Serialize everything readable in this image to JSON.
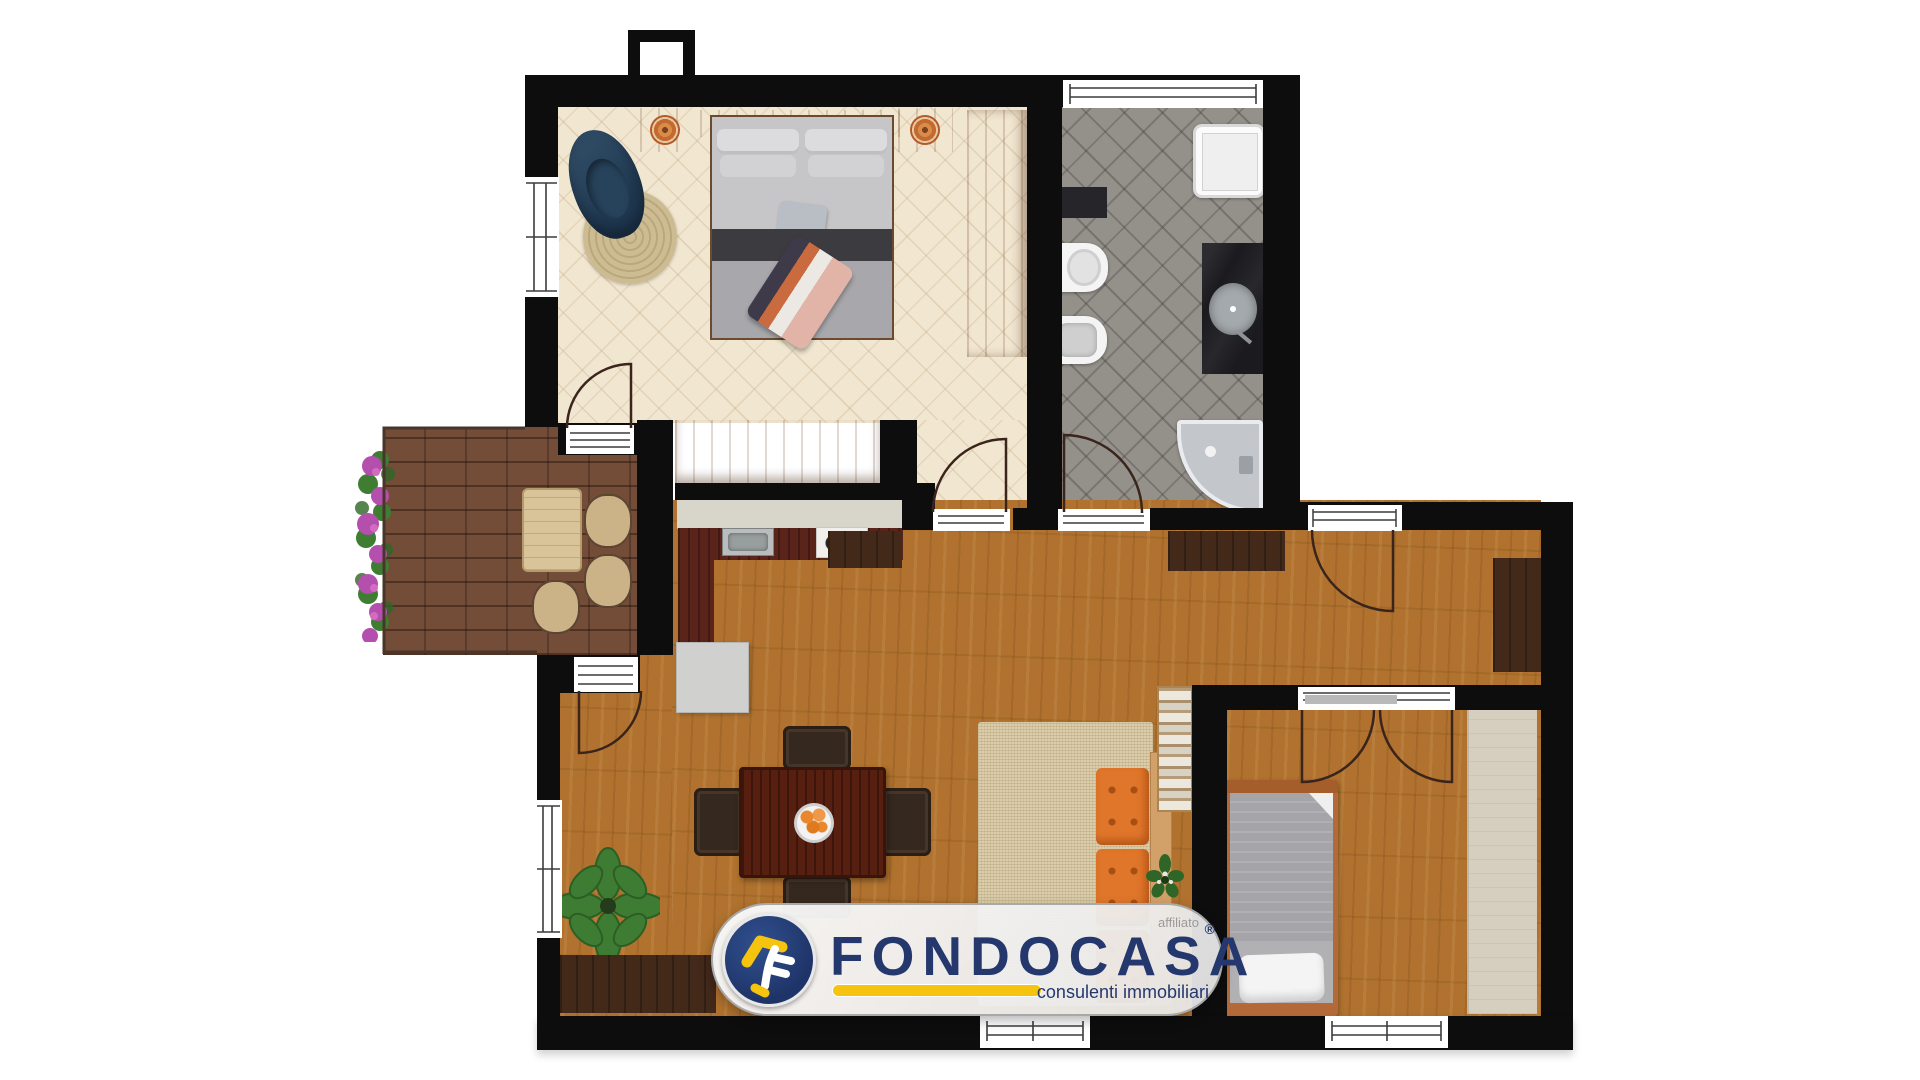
{
  "watermark": {
    "affiliate_label": "affiliato",
    "brand": "FONDOCASA",
    "registered_mark": "®",
    "tagline": "consulenti immobiliari",
    "colors": {
      "navy": "#25386e",
      "yellow": "#f6c40e",
      "pill_bg": "#f2f1ef",
      "pill_border": "#a8a8a8",
      "affiliate_gray": "#9a9a9a"
    }
  },
  "palette": {
    "background": "#ffffff",
    "wall": "#0d0d0d",
    "bedroom_floor": "#f1e6d0",
    "bathroom_floor": "#94908a",
    "balcony_floor": "#744d39",
    "wood_floor": "#b0722e",
    "light_wood_furniture": "#b3702c",
    "dark_wood_furniture": "#43291a",
    "kitchen_counter_top": "#d8d5ca",
    "kitchen_counter_base": "#5a241b",
    "rug_beige": "#dbcda9",
    "sofa_orange": "#e0762a",
    "plant_green": "#3d7c32",
    "flower_magenta": "#b44fae"
  },
  "floor_plan": {
    "type": "residential-apartment-2d-render",
    "rooms": [
      {
        "id": "bedroom-1",
        "position": "top-left",
        "floor": "cream-tile",
        "furniture": [
          "double-bed",
          "headboard-shelf",
          "nightstand-left",
          "nightstand-right",
          "wall-plate-left",
          "wall-plate-right",
          "round-jute-rug",
          "blue-armchair",
          "wardrobe-right",
          "wardrobe-bottom",
          "folded-throw"
        ]
      },
      {
        "id": "bathroom",
        "position": "top-right",
        "floor": "gray-tile",
        "furniture": [
          "shower-tray",
          "toilet",
          "bidet",
          "black-vanity-round-basin",
          "corner-bathtub",
          "wall-shelf"
        ]
      },
      {
        "id": "balcony",
        "position": "left",
        "floor": "brick-tile",
        "furniture": [
          "flower-planter",
          "outdoor-table",
          "outdoor-chairs"
        ]
      },
      {
        "id": "living-kitchen",
        "position": "center",
        "floor": "oak-plank",
        "furniture": [
          "kitchen-counter-sink-stove",
          "kitchen-island-table",
          "sideboard-left",
          "sideboard-tv",
          "corner-cabinet",
          "dining-table",
          "dining-chairs",
          "fruit-bowl",
          "large-plant",
          "beige-rug",
          "orange-sofa",
          "slatted-shelf",
          "small-plant",
          "low-sideboard"
        ]
      },
      {
        "id": "bedroom-2",
        "position": "bottom-right",
        "floor": "oak-plank",
        "furniture": [
          "single-bed",
          "pillow",
          "built-in-wardrobe"
        ]
      }
    ],
    "openings": [
      "bedroom1-balcony-door",
      "bedroom1-hall-door",
      "bathroom-door",
      "balcony-living-door",
      "french-window-top-right",
      "bedroom2-double-door",
      "window-bedroom1-left",
      "window-bathroom-top",
      "window-living-left",
      "window-living-bottom",
      "window-bedroom2-bottom",
      "chimney-vent"
    ]
  }
}
